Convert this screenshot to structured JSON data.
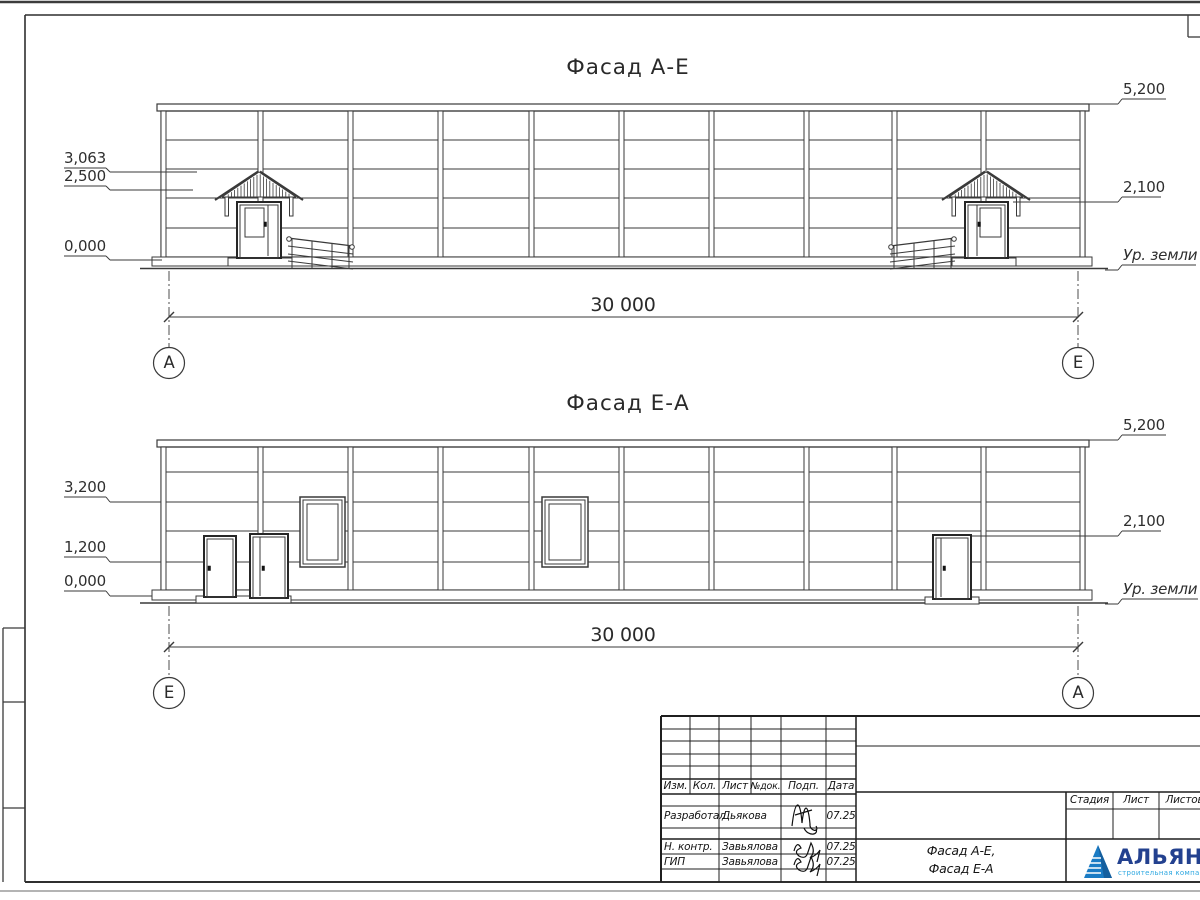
{
  "drawing": {
    "facade_top": {
      "title": "Фасад А-Е",
      "level_apex": "3,063",
      "level_canopy": "2,500",
      "level_zero": "0,000",
      "level_parapet": "5,200",
      "level_door": "2,100",
      "ground": "Ур. земли",
      "total_dim": "30 000",
      "axis_left": "А",
      "axis_right": "Е"
    },
    "facade_bottom": {
      "title": "Фасад Е-А",
      "level_3200": "3,200",
      "level_1200": "1,200",
      "level_zero": "0,000",
      "level_parapet": "5,200",
      "level_door": "2,100",
      "ground": "Ур. земли",
      "total_dim": "30 000",
      "axis_left": "Е",
      "axis_right": "А"
    },
    "titleblock": {
      "col_izm": "Изм.",
      "col_kol": "Кол.",
      "col_list": "Лист",
      "col_ndok": "№док.",
      "col_podp": "Подп.",
      "col_data": "Дата",
      "row_dev": {
        "role": "Разработал",
        "name": "Дьякова",
        "date": "07.25"
      },
      "row_ncontr": {
        "role": "Н. контр.",
        "name": "Завьялова",
        "date": "07.25"
      },
      "row_gip": {
        "role": "ГИП",
        "name": "Завьялова",
        "date": "07.25"
      },
      "doc_title_1": "Фасад А-Е,",
      "doc_title_2": "Фасад Е-А",
      "stage": "Стадия",
      "sheet": "Лист",
      "sheets": "Листов",
      "logo_name": "АЛЬЯНС",
      "logo_subtitle": "строительная компания",
      "logo_color": "#23418f",
      "logo_triangle_color": "#1a7bc4",
      "logo_subtitle_color": "#2fa8e1"
    }
  }
}
